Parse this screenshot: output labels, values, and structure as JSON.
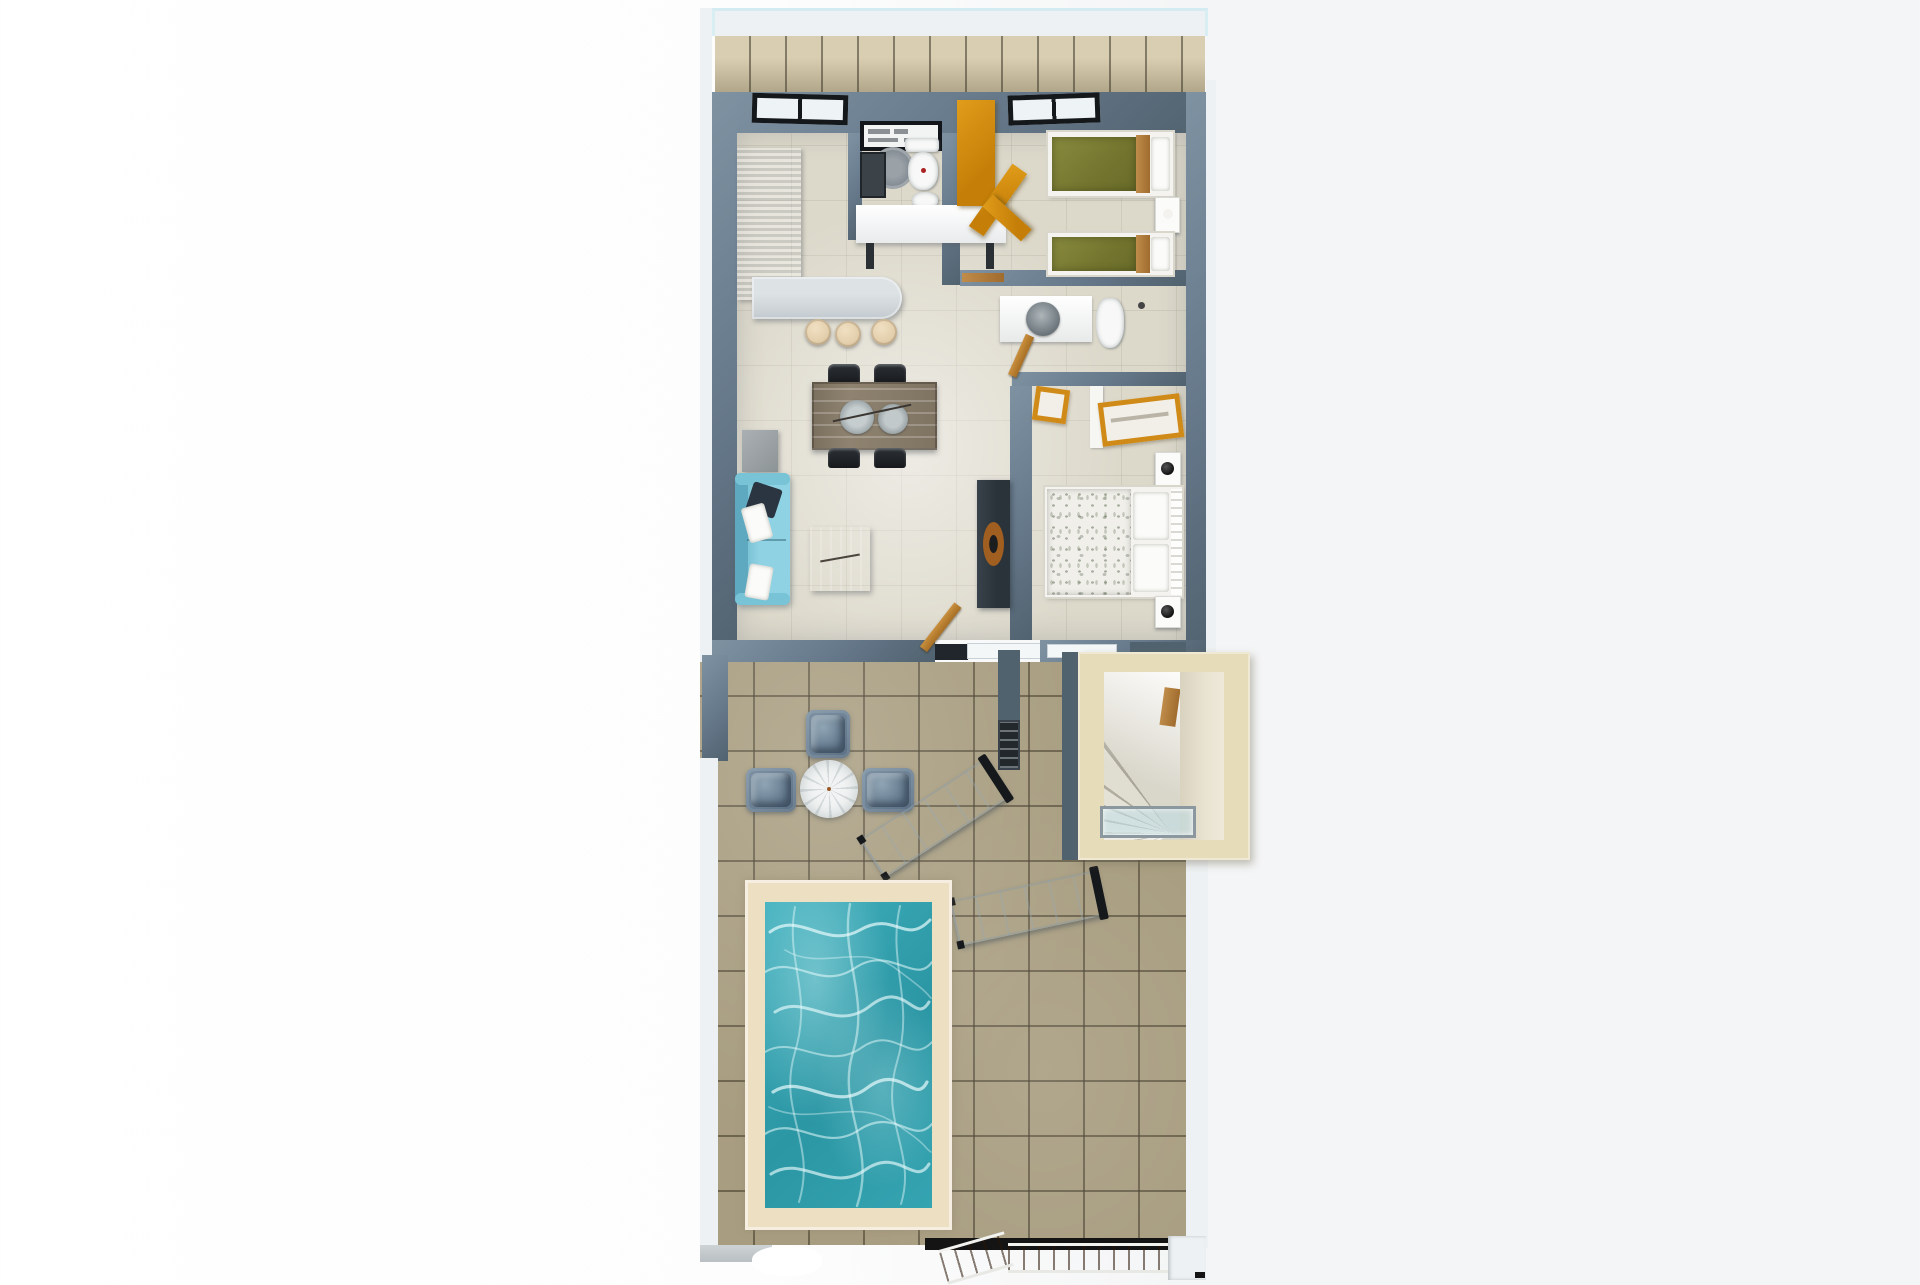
{
  "title": "3D apartment floor plan render with terrace and pool",
  "palette": {
    "outer-white": "#eef1f3",
    "wall": "#66798b",
    "wall-dark": "#51626f",
    "wall-light": "#7e92a2",
    "floor": "#dcd8ca",
    "balcony-tile": "#d2c5a4",
    "terrace-tile": "#a89d80",
    "pool-frame": "#ecdfc2",
    "water-1": "#42b1be",
    "water-2": "#2b96a4",
    "sofa-1": "#8fd2e3",
    "sofa-2": "#67b3c8",
    "stool": "#e3ceab",
    "stair-frame": "#e7dcba",
    "accent-orange": "#d7920f",
    "olive-mattress": "#74762f",
    "wood": "#b08048",
    "deck-wood": "#b5651d"
  },
  "scene": {
    "balcony": {
      "label": "Balcony with railing"
    },
    "rooms": [
      {
        "id": "kitchen",
        "label": "Kitchen",
        "furniture": [
          "L-shaped counter",
          "curved breakfast island",
          "3 bar stools"
        ]
      },
      {
        "id": "bathroom-1",
        "label": "Bathroom 1",
        "furniture": [
          "shower shelf unit",
          "toilet",
          "bidet",
          "dark vanity",
          "round rug"
        ]
      },
      {
        "id": "bedroom-twin",
        "label": "Twin bedroom",
        "furniture": [
          "2 single beds with olive covers",
          "wood nightstand",
          "orange desk",
          "orange chair"
        ]
      },
      {
        "id": "bathroom-2",
        "label": "Bathroom 2",
        "furniture": [
          "white vanity counter",
          "round basin",
          "toilet",
          "wood door"
        ]
      },
      {
        "id": "bedroom-master",
        "label": "Master bedroom",
        "furniture": [
          "double bed with patterned duvet",
          "2 white nightstands with black lamps",
          "2 orange luggage benches",
          "closet"
        ]
      },
      {
        "id": "living-dining",
        "label": "Living / dining room",
        "furniture": [
          "wood dining table",
          "4 black chairs",
          "light-blue sofa",
          "grey side table",
          "wood coffee table",
          "dark TV console with wooden bowl",
          "open wood door"
        ]
      }
    ],
    "terrace": {
      "label": "Terrace",
      "furniture": [
        "3 blue-grey armchairs",
        "round parasol table",
        "2 white sun loungers",
        "wall grill",
        "external stairwell",
        "swimming pool",
        "wood walkway",
        "angled wood ramp"
      ]
    },
    "pool": {
      "label": "Swimming pool"
    },
    "stairwell": {
      "label": "External stairwell with winding steps and glass rail"
    }
  }
}
